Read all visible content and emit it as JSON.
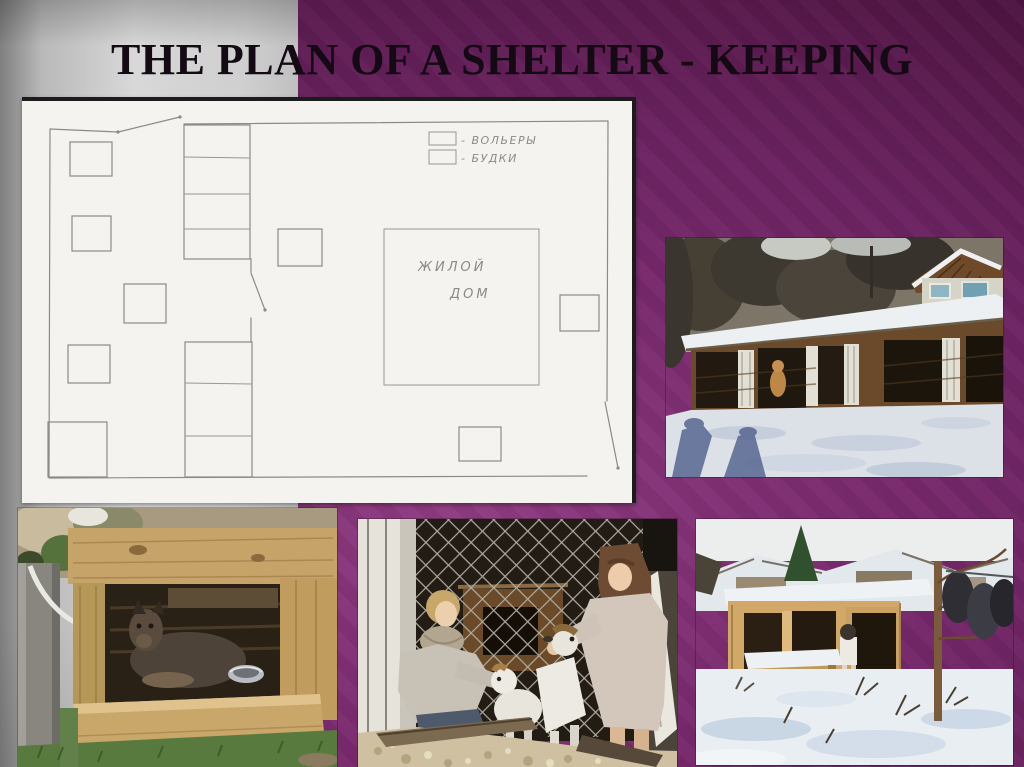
{
  "slide": {
    "title": "THE PLAN OF A SHELTER - KEEPING"
  },
  "colors": {
    "background_purple": "#6b2361",
    "background_purple_bright": "#8f3c82",
    "background_purple_dark": "#3c0d35",
    "panel_gray_light": "#d8d8d8",
    "panel_gray_dark": "#7f7f7f",
    "paper": "#f4f3ef",
    "pencil_gray": "#8a8a8a",
    "title_text": "#140a14"
  },
  "plan": {
    "kind": "hand-drawn pencil plan of the shelter territory",
    "legend": {
      "items": [
        {
          "symbol": "diagonal-hatch",
          "label": "- ВОЛЬЕРЫ"
        },
        {
          "symbol": "cross-hatch",
          "label": "- БУДКИ"
        }
      ]
    },
    "house": {
      "label_line1": "ЖИЛОЙ",
      "label_line2": "ДОМ"
    },
    "counts": {
      "kennel_squares": 7,
      "enclosure_strips": 2,
      "enclosure_cells": 7,
      "corner_enclosure": 1,
      "gates": 3
    }
  },
  "photos": [
    {
      "id": "winter-shelter-row",
      "description": "long wooden row of dog enclosures with snow-covered roof, white doors, village house behind, shadows of people on snow"
    },
    {
      "id": "dog-in-kennel",
      "description": "large dark dog lying inside a plywood kennel box with a metal bowl, chained post at left, grass in front"
    },
    {
      "id": "girls-with-dogs",
      "description": "two girls petting two white dogs beside a dark chain-link enclosure with a kennel opening"
    },
    {
      "id": "winter-yard-shelter",
      "description": "snowy yard with plywood shelter, snow-topped kennel box, small dog, bare tree and snowy roofs behind"
    }
  ]
}
